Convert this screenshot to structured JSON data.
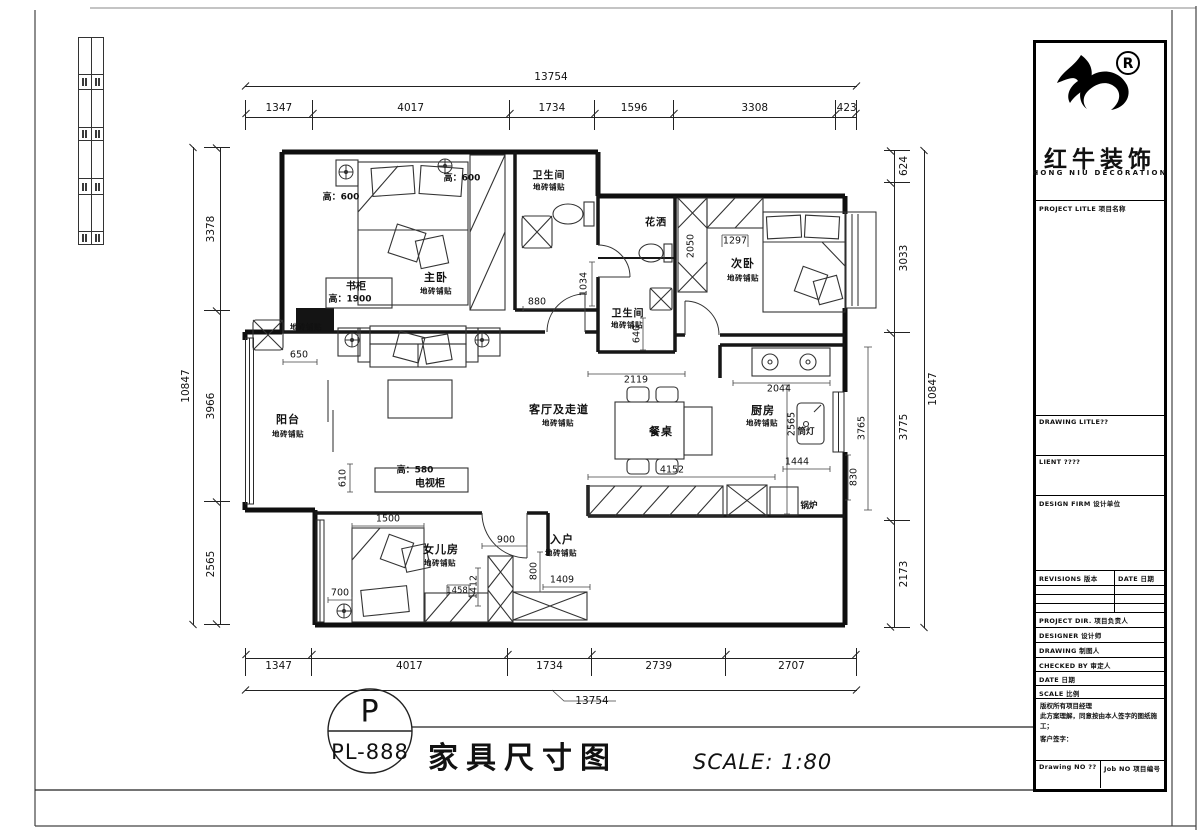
{
  "sheet": {
    "badge_letter": "P",
    "badge_code": "PL-888",
    "title": "家具尺寸图",
    "scale": "SCALE: 1:80"
  },
  "brand": {
    "registered_mark": "®",
    "name_cn": "红牛装饰",
    "name_en": "HONG NIU DECORATION"
  },
  "titleblock": {
    "project_title": "PROJECT LITLE 项目名称",
    "drawing_title": "DRAWING LITLE??",
    "client": "LIENT ????",
    "design_firm": "DESIGN FIRM 设计单位",
    "revisions": "REVISIONS 版本",
    "revisions_date": "DATE 日期",
    "project_dir": "PROJECT DIR.  项目负责人",
    "designer": "DESIGNER   设计师",
    "drawing": "DRAWING   制图人",
    "checked_by": "CHECKED BY  审定人",
    "date": "DATE    日期",
    "scale": "SCALE    比例",
    "note1": "版权所有项目经理",
    "note2": "此方案理解，同意按由本人签字的图纸施工；",
    "note3": "客户签字：",
    "drawing_no": "Drawing NO ??",
    "job_no": "Job NO 项目编号"
  },
  "dims": {
    "top_total": "13754",
    "top": [
      "1347",
      "4017",
      "1734",
      "1596",
      "3308",
      "423"
    ],
    "bottom": [
      "1347",
      "4017",
      "1734",
      "2739",
      "2707"
    ],
    "bottom_total": "13754",
    "left_total": "10847",
    "left": [
      "3378",
      "3966",
      "2565"
    ],
    "right_total": "10847",
    "right": [
      "624",
      "3033",
      "3775",
      "2173"
    ]
  },
  "inner_dims": {
    "d880": "880",
    "d1034": "1034",
    "d650": "650",
    "d2119": "2119",
    "d2050": "2050",
    "d1297": "1297",
    "d640": "640",
    "d2044": "2044",
    "d2565": "2565",
    "d3765": "3765",
    "d1444": "1444",
    "d830": "830",
    "d4152": "4152",
    "d610": "610",
    "d1500": "1500",
    "d700": "700",
    "d1458": "1458",
    "d1412": "1412",
    "d900": "900",
    "d800": "800",
    "d1409": "1409"
  },
  "rooms": {
    "master": {
      "name": "主卧",
      "finish": "地砖铺贴"
    },
    "bath_top": {
      "name": "卫生间",
      "finish": "地砖铺贴"
    },
    "shower": {
      "name": "花洒"
    },
    "bath_mid": {
      "name": "卫生间",
      "finish": "地砖铺贴"
    },
    "bedroom2": {
      "name": "次卧",
      "finish": "地砖铺贴"
    },
    "kitchen": {
      "name": "厨房",
      "finish": "地砖铺贴"
    },
    "living": {
      "name": "客厅及走道",
      "finish": "地砖铺贴"
    },
    "balcony": {
      "name": "阳台",
      "finish": "地砖铺贴"
    },
    "daughter": {
      "name": "女儿房",
      "finish": "地砖铺贴"
    },
    "entry": {
      "name": "入户",
      "finish": "地砖铺贴"
    },
    "dining_table": "餐桌",
    "tv_cabinet": "电视柜",
    "tv_cabinet_height": "高：580",
    "bookcase": "书柜",
    "bookcase_height": "高：1900",
    "boiler": "锅炉",
    "downlight": "筒灯",
    "tile_patch": "地砖铺贴",
    "height_600_left": "高：600",
    "height_600_right": "高：600"
  }
}
